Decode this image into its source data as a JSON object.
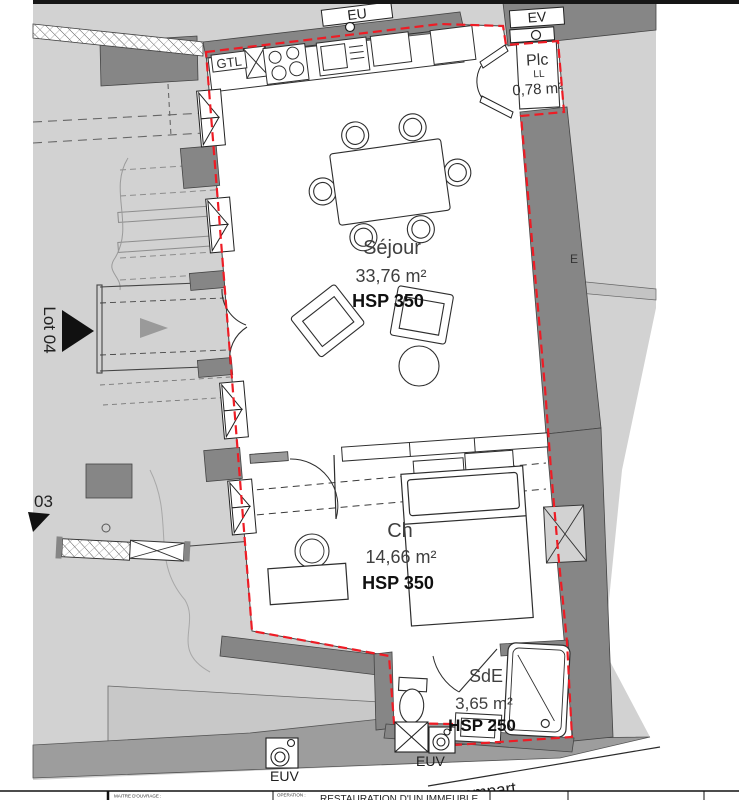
{
  "colors": {
    "field": "#d2d2d2",
    "wall": "#868686",
    "walkway": "#9d9d9d",
    "red_boundary": "#ee1c25",
    "ink": "#2e2e2e"
  },
  "rooms": {
    "sejour": {
      "name": "Séjour",
      "area": "33,76 m²",
      "hsp": "HSP 350"
    },
    "ch": {
      "name": "Ch",
      "area": "14,66 m²",
      "hsp": "HSP 350"
    },
    "sde": {
      "name": "SdE",
      "area": "3,65 m²",
      "hsp": "HSP 250"
    },
    "plc": {
      "name": "Plc",
      "appliance": "LL",
      "area": "0,78 m²"
    }
  },
  "annotations": {
    "eu": "EU",
    "ev": "EV",
    "euv_left": "EUV",
    "euv_right": "EUV",
    "gtl": "GTL",
    "lot04": "Lot 04",
    "lot03": "03",
    "facade": "E",
    "street": "rempart"
  },
  "titleblock": {
    "client_label": "MAITRE D'OUVRAGE :",
    "operation_label": "OPERATION :",
    "operation_value": "RESTAURATION D'UN IMMEUBLE"
  }
}
